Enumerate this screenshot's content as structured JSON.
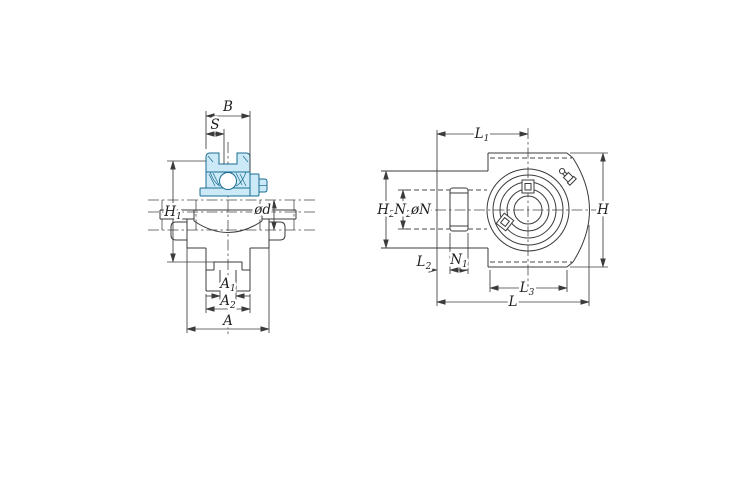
{
  "colors": {
    "background": "#ffffff",
    "line": "#3b3b3b",
    "bearing_fill": "#cbe9f6",
    "bearing_stroke": "#1a6d92"
  },
  "front": {
    "B": {
      "main": "B"
    },
    "S": {
      "main": "S"
    },
    "H1": {
      "main": "H",
      "sub": "1"
    },
    "OD": {
      "main": "ød"
    },
    "A1": {
      "main": "A",
      "sub": "1"
    },
    "A2": {
      "main": "A",
      "sub": "2"
    },
    "A": {
      "main": "A"
    }
  },
  "side": {
    "L1": {
      "main": "L",
      "sub": "1"
    },
    "H": {
      "main": "H"
    },
    "H2": {
      "main": "H",
      "sub": "2"
    },
    "N2": {
      "main": "N",
      "sub": "2"
    },
    "ON": {
      "main": "øN"
    },
    "L2": {
      "main": "L",
      "sub": "2"
    },
    "N1": {
      "main": "N",
      "sub": "1"
    },
    "L3": {
      "main": "L",
      "sub": "3"
    },
    "L": {
      "main": "L"
    }
  }
}
